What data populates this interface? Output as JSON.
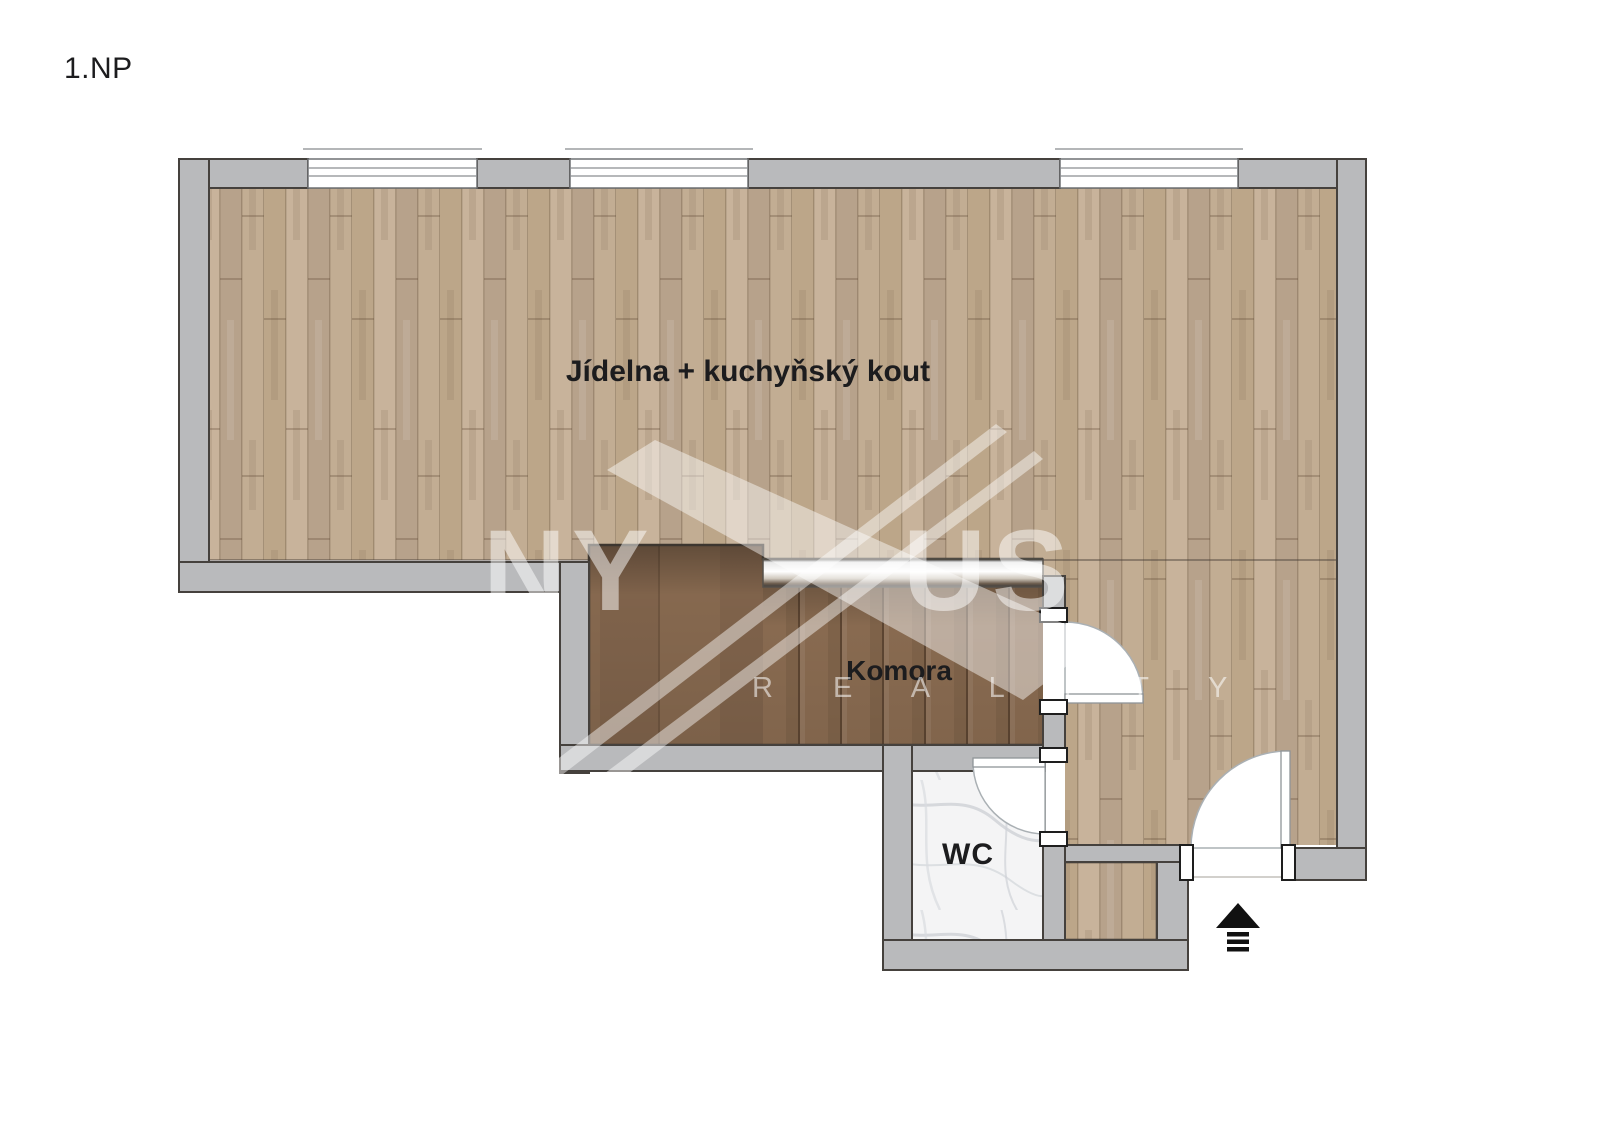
{
  "page": {
    "floor_label": "1.NP"
  },
  "rooms": [
    {
      "id": "dining-kitchen",
      "label": "Jídelna + kuchyňský kout"
    },
    {
      "id": "komora",
      "label": "Komora"
    },
    {
      "id": "wc",
      "label": "WC"
    }
  ],
  "watermark": {
    "brand_full": "NYXUS",
    "brand_left": "NY",
    "brand_right": "US",
    "subtitle": "R E A L I T Y"
  },
  "icons": {
    "entrance_arrow": "up-arrow-with-steps"
  },
  "colors": {
    "bg": "#ffffff",
    "wall": "#b9babc",
    "wall_outline": "#45413d",
    "floor_wood": "#c3ae95",
    "floor_gap": "#9a8570",
    "komora_wood": "#8d6e53",
    "komora_line": "#5f4935",
    "marble": "#f4f4f5",
    "marble_vein": "#c9ccd2",
    "window_fill": "#ffffff",
    "window_line": "#8a8d90",
    "door_arc": "#aab0b4",
    "text": "#1c1c1e",
    "arrow": "#111111",
    "watermark": "#ffffff"
  }
}
